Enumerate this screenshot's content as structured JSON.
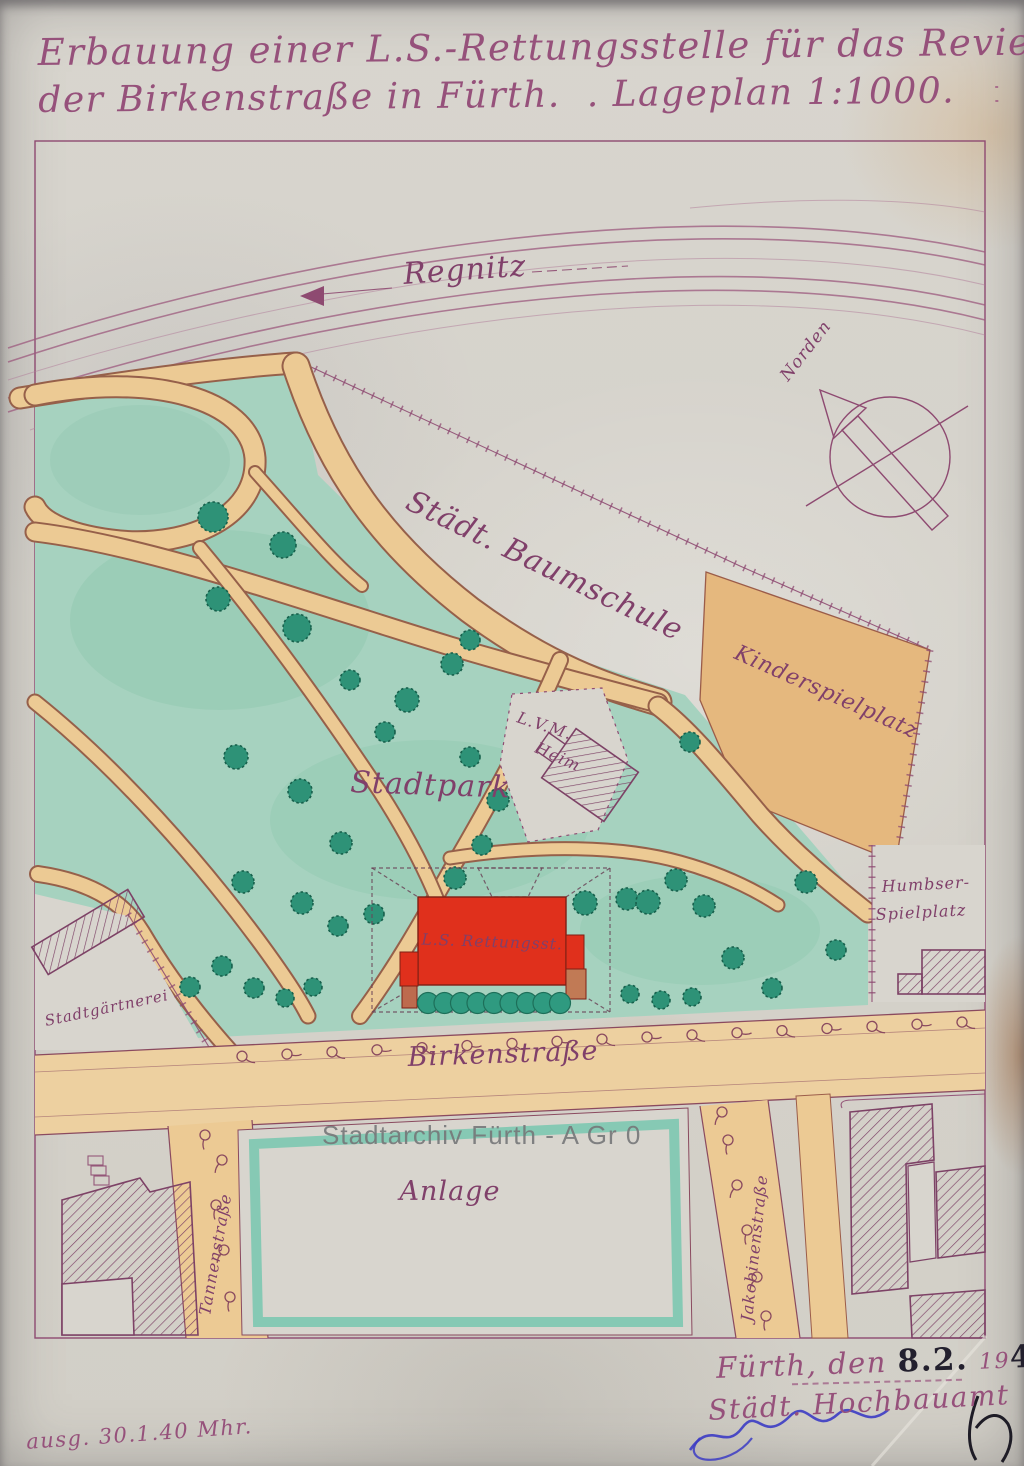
{
  "document": {
    "title_line1": "Erbauung einer L.S.-Rettungsstelle für das Revier 19 an",
    "title_line2": "der Birkenstraße in Fürth.",
    "title_scale": ". Lageplan 1:1000.",
    "watermark": "Stadtarchiv Fürth - A Gr 0",
    "issued_note": "ausg. 30.1.40 Mhr.",
    "signature_block": {
      "place_prefix": "Fürth, den",
      "date_value": "8.2.",
      "year_printed": "19",
      "year_value": "40",
      "office": "Städt. Hochbauamt"
    }
  },
  "map": {
    "labels": {
      "river": "Regnitz",
      "north": "Norden",
      "nursery": "Städt. Baumschule",
      "playground": "Kinderspielplatz",
      "park": "Stadtpark",
      "heim_line1": "L.V.M.",
      "heim_line2": "Heim",
      "rescue_station": "L.S. Rettungsst.",
      "street_main": "Birkenstraße",
      "green_area": "Anlage",
      "gardening": "Stadtgärtnerei",
      "humbser_line1": "Humbser-",
      "humbser_line2": "Spielplatz",
      "street_left": "Tannenstraße",
      "street_right": "Jakobinenstraße"
    },
    "colors": {
      "ink_purple": "#8e4a71",
      "park_green": "#a6d2bf",
      "tree_green": "#2e9277",
      "path_tan": "#ecca94",
      "playground_orange": "#e5b87e",
      "building_red": "#e0301c",
      "anlage_teal": "#86c9b4",
      "paper": "#d8d5ce",
      "signature_blue": "#3c3cc4"
    }
  }
}
